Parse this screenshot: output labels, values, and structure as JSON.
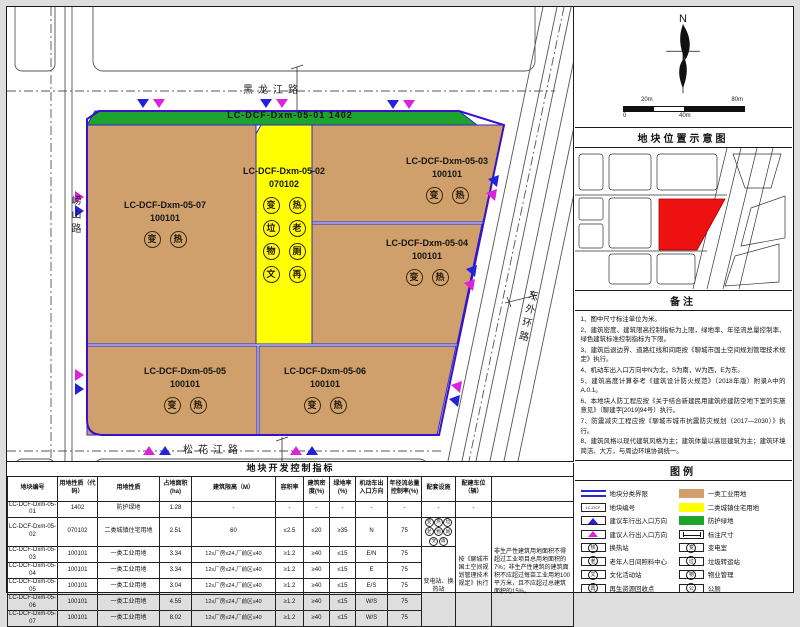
{
  "map": {
    "roads": {
      "north": "黑龙江路",
      "south": "松花江路",
      "west": "崂山路",
      "east": "东外环路"
    },
    "plots": [
      {
        "id": "LC-DCF-Dxm-05-01",
        "code": "1402",
        "badges": []
      },
      {
        "id": "LC-DCF-Dxm-05-02",
        "code": "070102",
        "badges": [
          "变",
          "热",
          "垃",
          "老",
          "物",
          "厕",
          "文",
          "再"
        ]
      },
      {
        "id": "LC-DCF-Dxm-05-03",
        "code": "100101",
        "badges": [
          "变",
          "热"
        ]
      },
      {
        "id": "LC-DCF-Dxm-05-04",
        "code": "100101",
        "badges": [
          "变",
          "热"
        ]
      },
      {
        "id": "LC-DCF-Dxm-05-05",
        "code": "100101",
        "badges": [
          "变",
          "热"
        ]
      },
      {
        "id": "LC-DCF-Dxm-05-06",
        "code": "100101",
        "badges": [
          "变",
          "热"
        ]
      },
      {
        "id": "LC-DCF-Dxm-05-07",
        "code": "100101",
        "badges": [
          "变",
          "热"
        ]
      }
    ],
    "colors": {
      "industrial": "#CFA06B",
      "residential": "#FFFF00",
      "green_space": "#1EA32F",
      "boundary": "#2A2AD2",
      "vehicle_arrow": "#2222DD",
      "pedestrian_arrow": "#DD22DD",
      "location_highlight": "#EE1111"
    }
  },
  "side": {
    "north_label": "N",
    "scale": {
      "top_left": "20m",
      "top_right": "80m",
      "bottom_left": "0",
      "bottom_mid": "40m"
    },
    "location_title": "地块位置示意图",
    "notes_title": "备注",
    "notes": [
      "1、图中尺寸标注单位为米。",
      "2、建筑密度、建筑限高控制指标为上限，绿地率、年径流总量控制率、绿色建筑标准控制指标为下限。",
      "3、建筑后退边界、道路红线和间距按《聊城市国土空间规划管理技术规定》执行。",
      "4、机动车出入口方向中N为北，S为南，W为西，E为东。",
      "5、建筑高度计算参考《建筑设计防火规范》（2018年版）附录A中的A.0.1。",
      "6、本地块人防工程应按《关于结合新建民用建筑修建防空地下室的实施意见》（聊建字[2019]94号）执行。",
      "7、防震减灾工程应按《聊城市城市抗震防灾规划（2017—2030）》执行。",
      "8、建筑风格以现代建筑风格为主；建筑体量以高层建筑为主；建筑环境简洁、大方，与周边环境协调统一。"
    ],
    "legend_title": "图例",
    "legend_left": [
      {
        "type": "boundary",
        "label": "地块分类界限"
      },
      {
        "type": "plotno",
        "glyph": "LC-DCF",
        "label": "地块编号"
      },
      {
        "type": "car-arrow",
        "label": "建议车行出入口方向"
      },
      {
        "type": "ped-arrow",
        "label": "建议人行出入口方向"
      },
      {
        "type": "circle",
        "glyph": "热",
        "label": "换热站"
      },
      {
        "type": "circle",
        "glyph": "老",
        "label": "老年人日间照料中心"
      },
      {
        "type": "circle",
        "glyph": "文",
        "label": "文化活动站"
      },
      {
        "type": "circle",
        "glyph": "再",
        "label": "再生资源回收点"
      }
    ],
    "legend_right": [
      {
        "type": "tan",
        "label": "一类工业用地"
      },
      {
        "type": "yellow",
        "label": "二类城镇住宅用地"
      },
      {
        "type": "green",
        "label": "防护绿地"
      },
      {
        "type": "dim",
        "label": "标注尺寸"
      },
      {
        "type": "circle",
        "glyph": "变",
        "label": "变电室"
      },
      {
        "type": "circle",
        "glyph": "垃",
        "label": "垃圾转运站"
      },
      {
        "type": "circle",
        "glyph": "物",
        "label": "物业管理"
      },
      {
        "type": "circle",
        "glyph": "公",
        "label": "公厕"
      }
    ]
  },
  "table": {
    "title": "地块开发控制指标",
    "headers": [
      "地块编号",
      "用地性质（代码）",
      "用地性质",
      "占地面积(ha)",
      "建筑限高（M）",
      "容积率",
      "建筑密度(%)",
      "绿地率(%)",
      "机动车出入口方向",
      "年径流总量控制率(%)",
      "配套设施",
      "配建车位（辆）",
      ""
    ],
    "rows": [
      [
        "LC-DCF-Dxm-05-01",
        "1402",
        "防护绿地",
        "1.28",
        "-",
        "-",
        "-",
        "-",
        "-",
        "-"
      ],
      [
        "LC-DCF-Dxm-05-02",
        "070102",
        "二类城镇住宅用地",
        "2.51",
        "60",
        "≤2.5",
        "≤20",
        "≥35",
        "N",
        "75"
      ],
      [
        "LC-DCF-Dxm-05-03",
        "100101",
        "一类工业用地",
        "3.34",
        "12≤厂房≤24,厂前区≤40",
        "≥1.2",
        "≥40",
        "≤15",
        "E/N",
        "75"
      ],
      [
        "LC-DCF-Dxm-05-04",
        "100101",
        "一类工业用地",
        "3.34",
        "12≤厂房≤24,厂前区≤40",
        "≥1.2",
        "≥40",
        "≤15",
        "E",
        "75"
      ],
      [
        "LC-DCF-Dxm-05-05",
        "100101",
        "一类工业用地",
        "3.04",
        "12≤厂房≤24,厂前区≤40",
        "≥1.2",
        "≥40",
        "≤15",
        "E/S",
        "75"
      ],
      [
        "LC-DCF-Dxm-05-06",
        "100101",
        "一类工业用地",
        "4.55",
        "12≤厂房≤24,厂前区≤40",
        "≥1.2",
        "≥40",
        "≤15",
        "W/S",
        "75"
      ],
      [
        "LC-DCF-Dxm-05-07",
        "100101",
        "一类工业用地",
        "8.02",
        "12≤厂房≤24,厂前区≤40",
        "≥1.2",
        "≥40",
        "≤15",
        "W/S",
        "75"
      ]
    ],
    "facility_row1": "-",
    "parking_row1": "-",
    "facility_merged": "变电站、换热站",
    "parking_merged": "按《聊城市国土空间规划管理技术规定》执行",
    "remark_merged": "非生产性建筑用地面积不得超过工业项目总用地面积的7%；非生产性建筑的建筑面积不应超过每亩工业用地100平方米，且不应超过总建筑面积的15%。"
  }
}
